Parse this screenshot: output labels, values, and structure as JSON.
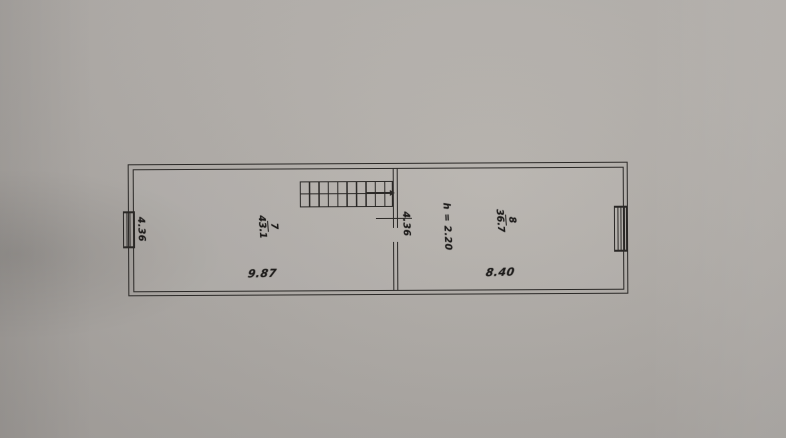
{
  "plan": {
    "colors": {
      "ink": "#2a2826",
      "paper": "#aca8a4",
      "paper_light": "#bdb9b4"
    },
    "rooms": [
      {
        "number": "7",
        "area": "43.1",
        "bottom_dimension": "9.87"
      },
      {
        "number": "8",
        "area": "36.7",
        "bottom_dimension": "8.40",
        "ceiling_height": "h = 2.20"
      }
    ],
    "side_dimensions": {
      "left_wall": "4.36",
      "partition": "4.36"
    }
  }
}
